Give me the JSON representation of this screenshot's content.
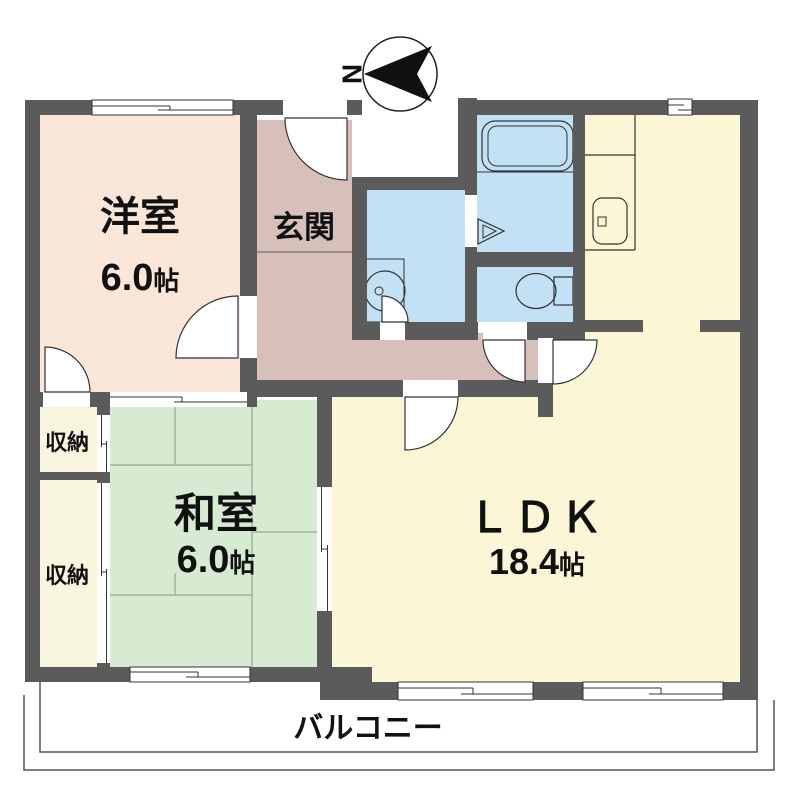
{
  "compass": {
    "north_label": "N"
  },
  "colors": {
    "wall": "#5b5b5b",
    "western_room": "#fbe7da",
    "entrance_hall": "#d8c0ba",
    "japanese_room": "#d7ebd3",
    "ldk": "#fbf7d6",
    "storage": "#f8f5de",
    "bathroom": "#c2e1f4",
    "outline": "#333333",
    "text": "#111111"
  },
  "rooms": {
    "western": {
      "name": "洋室",
      "area_value": "6.0",
      "area_unit": "帖"
    },
    "entrance": {
      "name": "玄関"
    },
    "japanese": {
      "name": "和室",
      "area_value": "6.0",
      "area_unit": "帖"
    },
    "ldk": {
      "name": "ＬＤＫ",
      "area_value": "18.4",
      "area_unit": "帖"
    },
    "storage1": {
      "name": "収納"
    },
    "storage2": {
      "name": "収納"
    },
    "balcony": {
      "name": "バルコニー"
    }
  }
}
